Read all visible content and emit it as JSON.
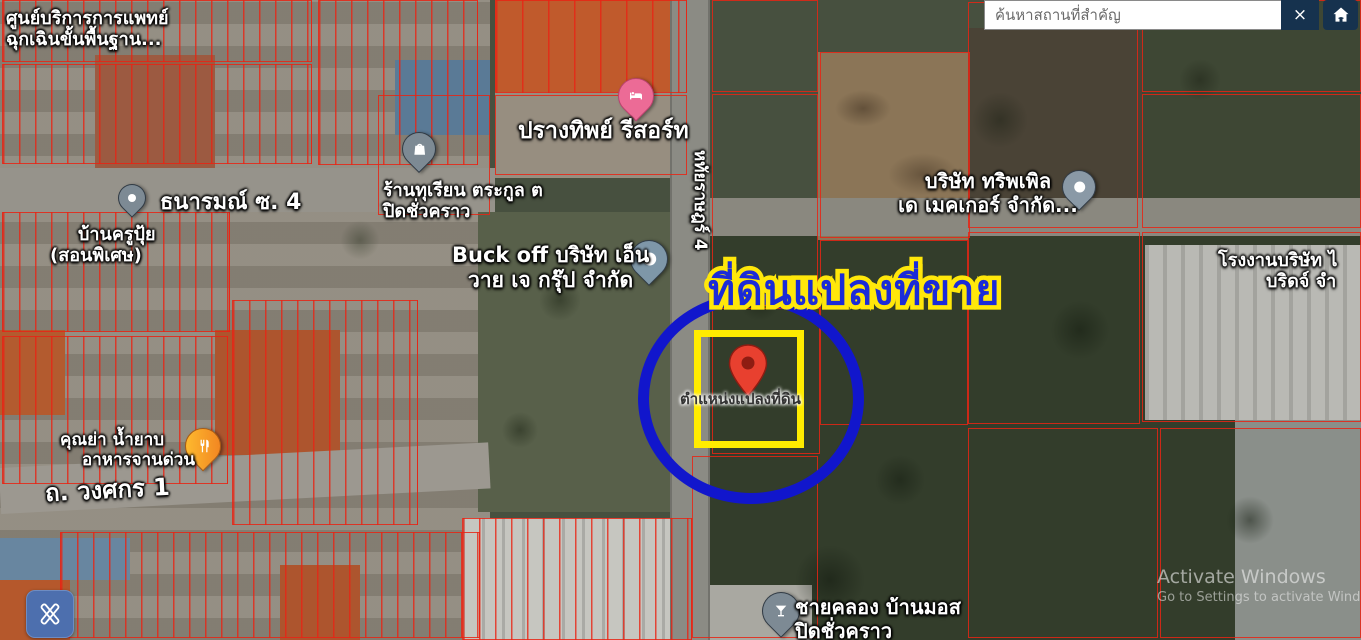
{
  "search": {
    "placeholder": "ค้นหาสถานที่สำคัญ",
    "clear_label": "×"
  },
  "watermark": {
    "line1": "Activate Windows",
    "line2": "Go to Settings to activate Windo"
  },
  "annotation": {
    "title": "ที่ดินแปลงที่ขาย",
    "pin_caption": "ตำแหน่งแปลงที่ดิน"
  },
  "labels": {
    "medical_center": {
      "line1": "ศูนย์บริการการแพทย์",
      "line2": "ฉุกเฉินขั้นพื้นฐาน..."
    },
    "thanarom_road": "ธนารมณ์ ซ. 4",
    "kru_pui": {
      "line1": "บ้านครูปุ้ย",
      "line2": "(สอนพิเศษ)"
    },
    "prangthip_resort": "ปรางทิพย์ รีสอร์ท",
    "durian_shop": {
      "line1": "ร้านทุเรียน ตระกูล ต",
      "line2": "ปิดชั่วคราว"
    },
    "buck_off": {
      "line1": "Buck off บริษัท เอ็น",
      "line2": "วาย เจ กรุ๊ป จำกัด"
    },
    "hathairat_road": "หทัยราษฎร์ 4",
    "tripled_company": {
      "line1": "บริษัท ทริพเพิล",
      "line2": "เด เมคเกอร์ จำกัด..."
    },
    "factory": {
      "line1": "โรงงานบริษัท ไ",
      "line2": "บริดจ์ จำ"
    },
    "grandma_food": {
      "line1": "คุณย่า น้ำยาบ",
      "line2": "อาหารจานด่วน"
    },
    "wongsakon_road": "ถ. วงศกร 1",
    "chaikhlong": {
      "line1": "ชายคลอง บ้านมอส",
      "line2": "ปิดชั่วคราว"
    }
  },
  "colors": {
    "annotation_blue": "#1116cc",
    "annotation_yellow": "#ffec00",
    "title_blue": "#1b2bd8",
    "title_outline": "#ffe70a",
    "parcel_red": "#e82414",
    "navy_button": "#16324e",
    "edit_button_blue": "#4d6fae"
  }
}
